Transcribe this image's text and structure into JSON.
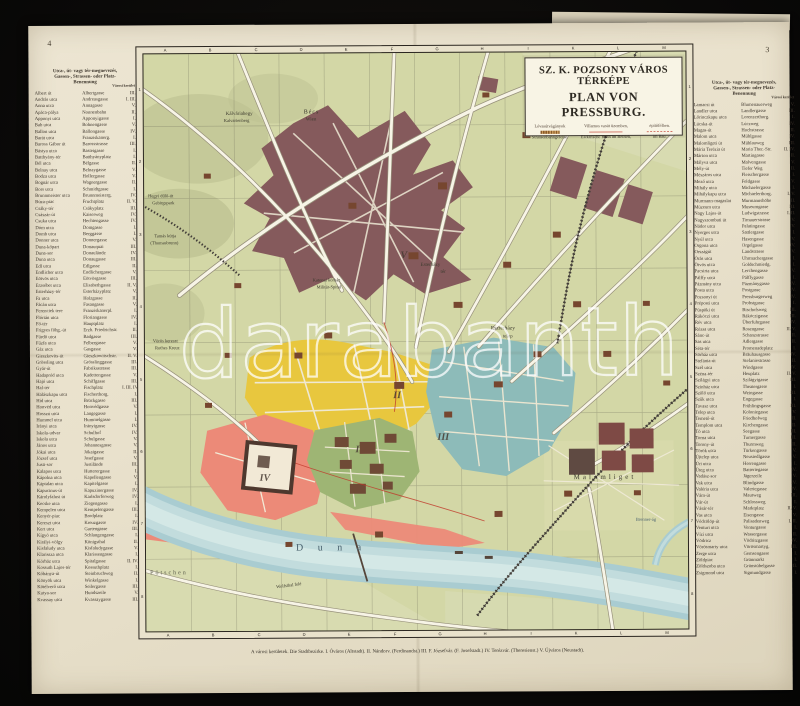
{
  "page": {
    "page_number_left": "4",
    "page_number_right": "3"
  },
  "colors": {
    "paper": "#e9e2cd",
    "map_background": "#d3d7a6",
    "district_yellow": "#e8c73e",
    "district_teal": "#8dbbb9",
    "district_pink": "#ec8a78",
    "district_maroon": "#855a5c",
    "district_green": "#9eb574",
    "river_blue": "#a9ccd1",
    "tram_red": "#c0392b",
    "ink": "#3b332a"
  },
  "cartouche": {
    "title_hu": "SZ. K. POZSONY VÁROS TÉRKÉPE",
    "title_de": "PLAN VON PRESSBURG.",
    "legend": {
      "hu1": "Lóvasútvágányok",
      "hu2": "Villamos vasút üzemben,",
      "hu3": "építőfélben.",
      "de1": "Strassenbahngeleise.",
      "de2": "Elektrische Bahn im Betrieb,",
      "de3": "im Bau."
    }
  },
  "map": {
    "grid_letters": [
      "A",
      "B",
      "C",
      "D",
      "E",
      "F",
      "G",
      "H",
      "I",
      "K",
      "L",
      "M"
    ],
    "grid_numbers": [
      "1",
      "2",
      "3",
      "4",
      "5",
      "6",
      "7",
      "8"
    ],
    "watermark": "darabanth",
    "caption": "A városi kerületek.   Die Stadtbezirke.   I. Óváros (Altstadt).   II. Nándorv. (Ferdinandst.)   III. F. Józsefvár. (F. Josefstadt.)   IV. Terézvár. (Theresienst.)   V. Újváros (Neustadt).",
    "labels": [
      {
        "text": "Bécs",
        "x": 160,
        "y": 56,
        "fs": 6,
        "ls": 1
      },
      {
        "text": "Wien",
        "x": 162,
        "y": 64,
        "fs": 5
      },
      {
        "text": "Kálváriahegy",
        "x": 82,
        "y": 58,
        "fs": 5
      },
      {
        "text": "Kalvarienberg",
        "x": 80,
        "y": 65,
        "fs": 4.5
      },
      {
        "text": "Hegyi dűlő-út",
        "x": 4,
        "y": 140,
        "fs": 4.5
      },
      {
        "text": "Gebirgspark",
        "x": 8,
        "y": 147,
        "fs": 4.5
      },
      {
        "text": "Tamás kútja",
        "x": 10,
        "y": 180,
        "fs": 4.5
      },
      {
        "text": "(Thomasbrunn)",
        "x": 6,
        "y": 187,
        "fs": 4.5
      },
      {
        "text": "Vörös kereszt",
        "x": 8,
        "y": 285,
        "fs": 4.5
      },
      {
        "text": "Rothes Kreuz",
        "x": 10,
        "y": 292,
        "fs": 4.5
      },
      {
        "text": "Katonai kórház",
        "x": 168,
        "y": 225,
        "fs": 4.5
      },
      {
        "text": "Militär-Spital",
        "x": 172,
        "y": 232,
        "fs": 4.5
      },
      {
        "text": "Esterházy",
        "x": 276,
        "y": 210,
        "fs": 5
      },
      {
        "text": "tér",
        "x": 296,
        "y": 217,
        "fs": 5
      },
      {
        "text": "Eszterházy",
        "x": 346,
        "y": 274,
        "fs": 5.5
      },
      {
        "text": "telep",
        "x": 358,
        "y": 282,
        "fs": 5
      },
      {
        "text": "Malomliget",
        "x": 428,
        "y": 422,
        "fs": 7,
        "ls": 3
      },
      {
        "text": "D u n a",
        "x": 150,
        "y": 490,
        "fs": 10,
        "ls": 6,
        "cls": "water"
      },
      {
        "text": "Pötschen",
        "x": 4,
        "y": 516,
        "fs": 6,
        "ls": 2,
        "cls": "muted"
      },
      {
        "text": "Wolfsthal felé",
        "x": 130,
        "y": 530,
        "fs": 4.5,
        "rot": -7
      },
      {
        "text": "Brenner-ág",
        "x": 490,
        "y": 466,
        "fs": 4.5,
        "cls": "water"
      },
      {
        "text": "I",
        "x": 210,
        "y": 392,
        "fs": 10,
        "cls": "numeral"
      },
      {
        "text": "II",
        "x": 248,
        "y": 338,
        "fs": 10,
        "cls": "numeral"
      },
      {
        "text": "III",
        "x": 292,
        "y": 380,
        "fs": 10,
        "cls": "numeral"
      },
      {
        "text": "IV",
        "x": 114,
        "y": 420,
        "fs": 10,
        "cls": "numeral"
      },
      {
        "text": "V",
        "x": 256,
        "y": 198,
        "fs": 10,
        "cls": "numeral"
      }
    ]
  },
  "index_left": {
    "header": [
      "Utca-, út- vagy tér-megnevezés,",
      "Gassen-, Strassen- oder Platz-",
      "Benennung"
    ],
    "district_header": "Városi kerület",
    "rows": [
      {
        "hu": "Albert út",
        "de": "Albertgasse",
        "d": "III."
      },
      {
        "hu": "András utca",
        "de": "Andreasgasse",
        "d": "I. III."
      },
      {
        "hu": "Anna utca",
        "de": "Annagasse",
        "d": "V."
      },
      {
        "hu": "Apáca-pálya",
        "de": "Nonnenbahn",
        "d": "II."
      },
      {
        "hu": "Apponyi utca",
        "de": "Apponyigasse",
        "d": "I."
      },
      {
        "hu": "Bab utca",
        "de": "Bohnengasse",
        "d": "V."
      },
      {
        "hu": "Ballon utca",
        "de": "Ballongasse",
        "d": "IV."
      },
      {
        "hu": "Barát utca",
        "de": "Franziskanerg.",
        "d": "I."
      },
      {
        "hu": "Baross Gábor út",
        "de": "Barossstrasse",
        "d": "III."
      },
      {
        "hu": "Bástya utca",
        "de": "Basteigasse",
        "d": "I."
      },
      {
        "hu": "Batthyány-tér",
        "de": "Batthyányplatz",
        "d": "I."
      },
      {
        "hu": "Bél utca",
        "de": "Bélgasse",
        "d": "II."
      },
      {
        "hu": "Belnay utca",
        "de": "Belnaygasse",
        "d": "V."
      },
      {
        "hu": "Bodza utca",
        "de": "Hollergasse",
        "d": "V."
      },
      {
        "hu": "Bognár utca",
        "de": "Wagnergasse",
        "d": "II."
      },
      {
        "hu": "Bors utca",
        "de": "Schmidtgasse",
        "d": "I."
      },
      {
        "hu": "Brunnmeister utca",
        "de": "Brunnmeisterg.",
        "d": "IV."
      },
      {
        "hu": "Búza-piac",
        "de": "Fruchtplatz",
        "d": "II. V."
      },
      {
        "hu": "Csáky-tér",
        "de": "Csákyplatz",
        "d": "III."
      },
      {
        "hu": "Császár-út",
        "de": "Kaiserweg",
        "d": "IV."
      },
      {
        "hu": "Csuka utca",
        "de": "Hechtengasse",
        "d": "IV."
      },
      {
        "hu": "Dóm utca",
        "de": "Domgasse",
        "d": "I."
      },
      {
        "hu": "Domb utca",
        "de": "Berggasse",
        "d": "I."
      },
      {
        "hu": "Donner utca",
        "de": "Donnergasse",
        "d": "V."
      },
      {
        "hu": "Duna-kőpart",
        "de": "Donauquai",
        "d": "III."
      },
      {
        "hu": "Duna-sor",
        "de": "Donaulände",
        "d": "IV."
      },
      {
        "hu": "Duna utca",
        "de": "Donaugasse",
        "d": "III."
      },
      {
        "hu": "Edl utca",
        "de": "Edlgasse",
        "d": "II."
      },
      {
        "hu": "Endlicher utca",
        "de": "Endlichergasse",
        "d": "V."
      },
      {
        "hu": "Eötvös utca",
        "de": "Eötvösgasse",
        "d": "III."
      },
      {
        "hu": "Erzsébet utca",
        "de": "Elisabethgasse",
        "d": "II. V."
      },
      {
        "hu": "Esterházy-tér",
        "de": "Esterházyplatz",
        "d": "V."
      },
      {
        "hu": "Fa utca",
        "de": "Holzgasse",
        "d": "II."
      },
      {
        "hu": "Fácán utca",
        "de": "Fasangasse",
        "d": "V."
      },
      {
        "hu": "Ferenciek tere",
        "de": "Franziskanerpl.",
        "d": "I."
      },
      {
        "hu": "Flórián utca",
        "de": "Floriangasse",
        "d": "IV."
      },
      {
        "hu": "Fő-tér",
        "de": "Hauptplatz",
        "d": "I."
      },
      {
        "hu": "Frigyes főhg.-út",
        "de": "Erzh. Friedrichstr.",
        "d": "II."
      },
      {
        "hu": "Fürdő utca",
        "de": "Badgasse",
        "d": "III."
      },
      {
        "hu": "Fűzfa utca",
        "de": "Felbergasse",
        "d": "V."
      },
      {
        "hu": "Gáz utca",
        "de": "Gasgasse",
        "d": "V."
      },
      {
        "hu": "Gieszkovits-út",
        "de": "Gieszkowitschstr.",
        "d": "II. V."
      },
      {
        "hu": "Grössling utca",
        "de": "Grösslinggasse",
        "d": "III."
      },
      {
        "hu": "Gyár-út",
        "de": "Fabriksstrasse",
        "d": "III."
      },
      {
        "hu": "Hadapród utca",
        "de": "Kadettengasse",
        "d": "V."
      },
      {
        "hu": "Hajó utca",
        "de": "Schiffgasse",
        "d": "III."
      },
      {
        "hu": "Hal-tér",
        "de": "Fischplatz",
        "d": "I. III. IV."
      },
      {
        "hu": "Halászkapu utca",
        "de": "Fischerthorg.",
        "d": "I."
      },
      {
        "hu": "Híd utca",
        "de": "Brückgasse",
        "d": "III."
      },
      {
        "hu": "Honvéd utca",
        "de": "Honvédgasse",
        "d": "V."
      },
      {
        "hu": "Hosszú utca",
        "de": "Langegasse",
        "d": "I."
      },
      {
        "hu": "Hummel utca",
        "de": "Hummelgasse",
        "d": "I."
      },
      {
        "hu": "Irányi utca",
        "de": "Irányigasse",
        "d": "IV."
      },
      {
        "hu": "Iskola-udvar",
        "de": "Schulhof",
        "d": "IV."
      },
      {
        "hu": "Iskola utca",
        "de": "Schulgasse",
        "d": "V."
      },
      {
        "hu": "János utca",
        "de": "Johannesgasse",
        "d": "V."
      },
      {
        "hu": "Jókai utca",
        "de": "Jókaigasse",
        "d": "II."
      },
      {
        "hu": "József utca",
        "de": "Josefgasse",
        "d": "V."
      },
      {
        "hu": "Justi-sor",
        "de": "Justilände",
        "d": "III."
      },
      {
        "hu": "Kalapos utca",
        "de": "Hutterergasse",
        "d": "I."
      },
      {
        "hu": "Kápolna utca",
        "de": "Kapellengasse",
        "d": "V."
      },
      {
        "hu": "Káptalan utca",
        "de": "Kapitelgasse",
        "d": "I."
      },
      {
        "hu": "Kapucinus-út",
        "de": "Kapuzinergasse",
        "d": "IV."
      },
      {
        "hu": "Károlyfalusi út",
        "de": "Karlsdorferweg",
        "d": "IV."
      },
      {
        "hu": "Kecske utca",
        "de": "Ziegengasse",
        "d": "I."
      },
      {
        "hu": "Kempelen utca",
        "de": "Kempelengasse",
        "d": "III."
      },
      {
        "hu": "Kenyér-piac",
        "de": "Brodplatz",
        "d": "I."
      },
      {
        "hu": "Kereszt utca",
        "de": "Kreuzgasse",
        "d": "IV."
      },
      {
        "hu": "Kert utca",
        "de": "Gartengasse",
        "d": "III."
      },
      {
        "hu": "Kígyó utca",
        "de": "Schlangengasse",
        "d": "I."
      },
      {
        "hu": "Királyi-völgy",
        "de": "Königsthal",
        "d": "II."
      },
      {
        "hu": "Kisfaludy utca",
        "de": "Kisfaludygasse",
        "d": "V."
      },
      {
        "hu": "Klarissza utca",
        "de": "Klarissengasse",
        "d": "I."
      },
      {
        "hu": "Kórház utca",
        "de": "Spitalgasse",
        "d": "II. IV."
      },
      {
        "hu": "Kossuth Lajos-tér",
        "de": "Kossuthplatz",
        "d": "I."
      },
      {
        "hu": "Kőbánya-út",
        "de": "Steinbruchweg",
        "d": "II."
      },
      {
        "hu": "Könyök utca",
        "de": "Winkelgasse",
        "d": "I."
      },
      {
        "hu": "Kötélverő utca",
        "de": "Seilergasse",
        "d": "III."
      },
      {
        "hu": "Kutya-sor",
        "de": "Hundszeile",
        "d": "V."
      },
      {
        "hu": "Kvassay utca",
        "de": "Kvassaygasse",
        "d": "III."
      }
    ]
  },
  "index_right": {
    "header": [
      "Utca-, út- vagy tér-megnevezés,",
      "Gassen-, Strassen- oder Platz-",
      "Benennung"
    ],
    "district_header": "Városi kerület",
    "rows": [
      {
        "hu": "Lamacsi út",
        "de": "Blumenauerweg",
        "d": "V."
      },
      {
        "hu": "Landler utca",
        "de": "Landlergasse",
        "d": "III."
      },
      {
        "hu": "Lőrinczkapu utca",
        "de": "Lorenzerthorg.",
        "d": "I."
      },
      {
        "hu": "Lúcska-út",
        "de": "Lúczweg",
        "d": "IV."
      },
      {
        "hu": "Magas-út",
        "de": "Hochstrasse",
        "d": "II."
      },
      {
        "hu": "Malom utca",
        "de": "Mühlgasse",
        "d": "IV."
      },
      {
        "hu": "Malomligeti út",
        "de": "Mühlauweg",
        "d": "III."
      },
      {
        "hu": "Mária Terézia út",
        "de": "Maria Ther.-Str.",
        "d": "II. IV."
      },
      {
        "hu": "Márton utca",
        "de": "Martingasse",
        "d": "II."
      },
      {
        "hu": "Mályva utca",
        "de": "Malvengasse",
        "d": "V."
      },
      {
        "hu": "Mély-út",
        "de": "Tiefer Weg",
        "d": "II."
      },
      {
        "hu": "Mészáros utca",
        "de": "Fleischergasse",
        "d": "I."
      },
      {
        "hu": "Mező utca",
        "de": "Feldgasse",
        "d": "V."
      },
      {
        "hu": "Mihály utca",
        "de": "Michaelergasse",
        "d": "I."
      },
      {
        "hu": "Mihálykapu utca",
        "de": "Michaelerthorg.",
        "d": "I. V."
      },
      {
        "hu": "Murmann-magaslat",
        "de": "Murmannshöhe",
        "d": "II."
      },
      {
        "hu": "Múzeum utca",
        "de": "Museumgasse",
        "d": "III."
      },
      {
        "hu": "Nagy Lajos-út",
        "de": "Ludwigstrasse",
        "d": "I. II."
      },
      {
        "hu": "Nagyszombati út",
        "de": "Tirnauerstrasse",
        "d": "V."
      },
      {
        "hu": "Nádor utca",
        "de": "Palatingasse",
        "d": "V."
      },
      {
        "hu": "Nyerges utca",
        "de": "Sattlergasse",
        "d": "I."
      },
      {
        "hu": "Nyúl utca",
        "de": "Hasengasse",
        "d": "V."
      },
      {
        "hu": "Orgona utca",
        "de": "Orgelgasse",
        "d": "IV."
      },
      {
        "hu": "Országút",
        "de": "Landstrasse",
        "d": "V."
      },
      {
        "hu": "Órás utca",
        "de": "Uhrmachergasse",
        "d": "I."
      },
      {
        "hu": "Ötvös utca",
        "de": "Goldschmiedg.",
        "d": "I."
      },
      {
        "hu": "Pacsirta utca",
        "de": "Lerchengasse",
        "d": "V."
      },
      {
        "hu": "Pálffy utca",
        "de": "Pálffygasse",
        "d": "I."
      },
      {
        "hu": "Pázmány utca",
        "de": "Pázmánygasse",
        "d": "IV."
      },
      {
        "hu": "Posta utca",
        "de": "Postgasse",
        "d": "IV."
      },
      {
        "hu": "Pozsonyi út",
        "de": "Pressburgerweg",
        "d": "IV."
      },
      {
        "hu": "Préposti utca",
        "de": "Probstgasse",
        "d": "I."
      },
      {
        "hu": "Püspöki út",
        "de": "Bischofsweg",
        "d": "III."
      },
      {
        "hu": "Rákóczi utca",
        "de": "Rákóczigasse",
        "d": "III."
      },
      {
        "hu": "Rév utca",
        "de": "Überfuhrgasse",
        "d": "IV."
      },
      {
        "hu": "Rózsa utca",
        "de": "Rosengasse",
        "d": "II. V."
      },
      {
        "hu": "Sánc-út",
        "de": "Schanzstrasse",
        "d": "II."
      },
      {
        "hu": "Sas utca",
        "de": "Adlergasse",
        "d": "II."
      },
      {
        "hu": "Séta-tér",
        "de": "Promenadeplatz",
        "d": "I."
      },
      {
        "hu": "Sörház utca",
        "de": "Bräuhausgasse",
        "d": "IV."
      },
      {
        "hu": "Stefánia-út",
        "de": "Stefaniestrasse",
        "d": "II."
      },
      {
        "hu": "Szél utca",
        "de": "Windgasse",
        "d": "IV."
      },
      {
        "hu": "Széna-tér",
        "de": "Heuplatz",
        "d": "II. V."
      },
      {
        "hu": "Szilágyi utca",
        "de": "Szilágyigasse",
        "d": "III."
      },
      {
        "hu": "Színház utca",
        "de": "Theatergasse",
        "d": "I."
      },
      {
        "hu": "Szőlő utca",
        "de": "Weingasse",
        "d": "III."
      },
      {
        "hu": "Szűk utca",
        "de": "Engegasse",
        "d": "I."
      },
      {
        "hu": "Tavasz utca",
        "de": "Frühlingsgasse",
        "d": "III."
      },
      {
        "hu": "Telep utca",
        "de": "Koloniegasse",
        "d": "V."
      },
      {
        "hu": "Temető-út",
        "de": "Friedhofweg",
        "d": "II."
      },
      {
        "hu": "Templom utca",
        "de": "Kirchengasse",
        "d": "II."
      },
      {
        "hu": "Tó utca",
        "de": "Seegasse",
        "d": "III."
      },
      {
        "hu": "Torna utca",
        "de": "Turnergasse",
        "d": "III."
      },
      {
        "hu": "Torony-út",
        "de": "Thurmweg",
        "d": "II."
      },
      {
        "hu": "Török utca",
        "de": "Türkengasse",
        "d": "V."
      },
      {
        "hu": "Újtelep utca",
        "de": "Neusiedlgasse",
        "d": "V."
      },
      {
        "hu": "Úri utca",
        "de": "Herrengasse",
        "d": "I."
      },
      {
        "hu": "Üteg utca",
        "de": "Batteriegasse",
        "d": "IV."
      },
      {
        "hu": "Vadász-sor",
        "de": "Jägerzeile",
        "d": "V."
      },
      {
        "hu": "Vak utca",
        "de": "Blindgasse",
        "d": "IV."
      },
      {
        "hu": "Valéria utca",
        "de": "Valeriegasse",
        "d": "IV."
      },
      {
        "hu": "Vám-út",
        "de": "Mautweg",
        "d": "III."
      },
      {
        "hu": "Vár-út",
        "de": "Schlossweg",
        "d": "I."
      },
      {
        "hu": "Vásár-tér",
        "de": "Marktplatz",
        "d": "II. V."
      },
      {
        "hu": "Vas utca",
        "de": "Eisengasse",
        "d": "V."
      },
      {
        "hu": "Védcölöp-út",
        "de": "Palisadenweg",
        "d": "I. II."
      },
      {
        "hu": "Venturi utca",
        "de": "Venturgasse",
        "d": "I."
      },
      {
        "hu": "Vízi utca",
        "de": "Wassergasse",
        "d": "II."
      },
      {
        "hu": "Vödricz",
        "de": "Vödritzgasse",
        "d": "IV."
      },
      {
        "hu": "Vörösmarty utca",
        "de": "Vörösmartyg.",
        "d": "III."
      },
      {
        "hu": "Zerge utca",
        "de": "Gemsengasse",
        "d": "I."
      },
      {
        "hu": "Zöldpiac",
        "de": "Grünmarkt",
        "d": "I."
      },
      {
        "hu": "Zöldszoba utca",
        "de": "Grünstübelgasse",
        "d": "II."
      },
      {
        "hu": "Zsigmond utca",
        "de": "Sigmundgasse",
        "d": "I."
      }
    ]
  }
}
